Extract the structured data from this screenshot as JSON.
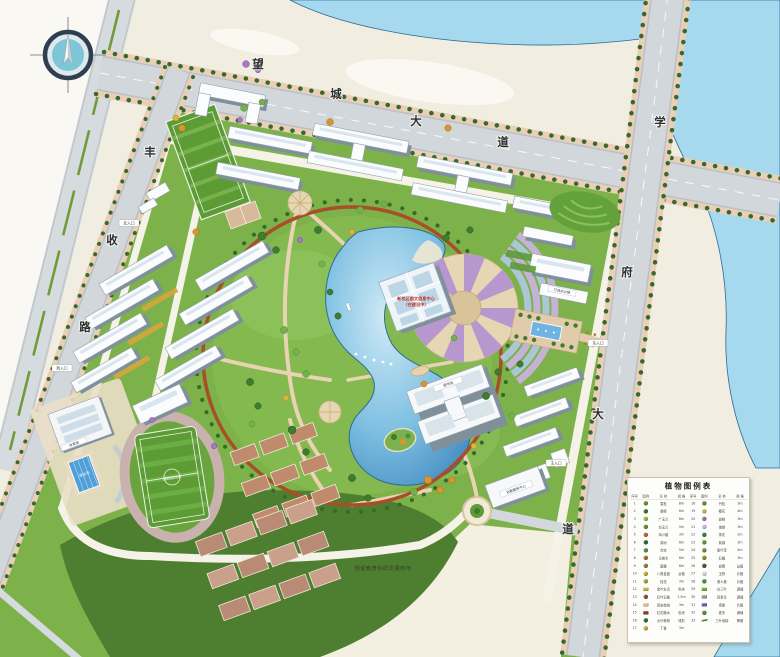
{
  "title": "校园总平面规划图",
  "colors": {
    "water": "#a6d9ee",
    "lake_deep": "#3f88c0",
    "campus_green": "#7cb249",
    "reserved_green": "#4e7f30",
    "ring_road": "#a84e28",
    "road_gray": "#ced4d9",
    "sidewalk_pink": "#eacfb8",
    "court_brown": "#c08b6c"
  },
  "roads": {
    "top": {
      "name": "望城大道",
      "chars": [
        "望",
        "城",
        "大",
        "道"
      ]
    },
    "east": {
      "name": "学府大道",
      "chars": [
        "学",
        "府",
        "大",
        "道"
      ]
    },
    "west": {
      "name": "丰收路",
      "chars": [
        "丰",
        "收",
        "路"
      ]
    }
  },
  "labels": {
    "reserved_land": "预留教育科研发展用地",
    "stadium": "田径运动场",
    "gym": "体育馆",
    "pool": "游泳池",
    "center_building_line1": "新校区图文信息中心",
    "center_building_line2": "（在建设中）",
    "admin": "行政办公楼",
    "library": "图书馆",
    "service": "后勤服务中心",
    "entrance_north": "北入口",
    "entrance_west": "西入口",
    "entrance_east": "东入口",
    "entrance_main": "主入口"
  },
  "legend": {
    "title": "植物图例表",
    "headers": [
      "序号",
      "图例",
      "名 称",
      "规 格"
    ],
    "rows": [
      {
        "no": 1,
        "name": "雪松",
        "spec": "8m",
        "color": "#6b8c2d",
        "shape": "circle"
      },
      {
        "no": 2,
        "name": "香樟",
        "spec": "6m",
        "color": "#3c6b2a",
        "shape": "circle"
      },
      {
        "no": 3,
        "name": "广玉兰",
        "spec": "6m",
        "color": "#9bb13f",
        "shape": "circle"
      },
      {
        "no": 4,
        "name": "白玉兰",
        "spec": "5m",
        "color": "#578d30",
        "shape": "circle"
      },
      {
        "no": 5,
        "name": "鸡爪槭",
        "spec": "3m",
        "color": "#b5652f",
        "shape": "circle"
      },
      {
        "no": 6,
        "name": "栾树",
        "spec": "6m",
        "color": "#2f6130",
        "shape": "circle"
      },
      {
        "no": 7,
        "name": "合欢",
        "spec": "5m",
        "color": "#4f8f3c",
        "shape": "circle"
      },
      {
        "no": 8,
        "name": "马褂木",
        "spec": "6m",
        "color": "#a06b28",
        "shape": "circle"
      },
      {
        "no": 9,
        "name": "国槐",
        "spec": "6m",
        "color": "#8a7a33",
        "shape": "circle"
      },
      {
        "no": 10,
        "name": "八角金盘",
        "spec": "丛植",
        "color": "#c9a62e",
        "shape": "circle"
      },
      {
        "no": 11,
        "name": "桂花",
        "spec": "3m",
        "color": "#97a52f",
        "shape": "circle"
      },
      {
        "no": 12,
        "name": "金叶女贞",
        "spec": "色块",
        "color": "#c8b13c",
        "shape": "rect"
      },
      {
        "no": 13,
        "name": "红叶石楠",
        "spec": "1.5m",
        "color": "#8b4a3b",
        "shape": "circle"
      },
      {
        "no": 14,
        "name": "西安桧柏",
        "spec": "3m",
        "color": "#d8c089",
        "shape": "rect"
      },
      {
        "no": 15,
        "name": "红花檵木",
        "spec": "色块",
        "color": "#8f3a30",
        "shape": "rect"
      },
      {
        "no": 16,
        "name": "大叶黄杨",
        "spec": "球形",
        "color": "#2f6e3c",
        "shape": "circle"
      },
      {
        "no": 17,
        "name": "丁香",
        "spec": "3m",
        "color": "#caa43f",
        "shape": "circle"
      },
      {
        "no": 18,
        "name": "丹桂",
        "spec": "3m",
        "color": "#5e8f2f",
        "shape": "circle"
      },
      {
        "no": 19,
        "name": "樱花",
        "spec": "4m",
        "color": "#c9b23e",
        "shape": "circle"
      },
      {
        "no": 20,
        "name": "碧桃",
        "spec": "3m",
        "color": "#9a6fb5",
        "shape": "circle"
      },
      {
        "no": 21,
        "name": "海棠",
        "spec": "3m",
        "color": "#c9b6e2",
        "shape": "circle"
      },
      {
        "no": 22,
        "name": "茶花",
        "spec": "2m",
        "color": "#3f7d33",
        "shape": "circle"
      },
      {
        "no": 23,
        "name": "紫薇",
        "spec": "3m",
        "color": "#5f9638",
        "shape": "circle"
      },
      {
        "no": 24,
        "name": "紫叶李",
        "spec": "4m",
        "color": "#6d8f2f",
        "shape": "circle"
      },
      {
        "no": 25,
        "name": "石榴",
        "spec": "3m",
        "color": "#97862f",
        "shape": "circle"
      },
      {
        "no": 26,
        "name": "迎春",
        "spec": "丛植",
        "color": "#3f5e2a",
        "shape": "circle"
      },
      {
        "no": 27,
        "name": "玉簪",
        "spec": "片植",
        "color": "#d8d2e8",
        "shape": "circle"
      },
      {
        "no": 28,
        "name": "美人蕉",
        "spec": "片植",
        "color": "#4f8f33",
        "shape": "circle"
      },
      {
        "no": 29,
        "name": "白三叶",
        "spec": "满铺",
        "color": "#6fae3c",
        "shape": "rect"
      },
      {
        "no": 30,
        "name": "四季青",
        "spec": "满铺",
        "color": "#8fa08f",
        "shape": "rect"
      },
      {
        "no": 31,
        "name": "鸢尾",
        "spec": "片植",
        "color": "#7a5fa8",
        "shape": "rect"
      },
      {
        "no": 32,
        "name": "麦冬",
        "spec": "满铺",
        "color": "#568f2f",
        "shape": "circle"
      },
      {
        "no": 33,
        "name": "三叶地锦",
        "spec": "攀援",
        "color": "#4a6b2a",
        "shape": "line"
      }
    ]
  }
}
